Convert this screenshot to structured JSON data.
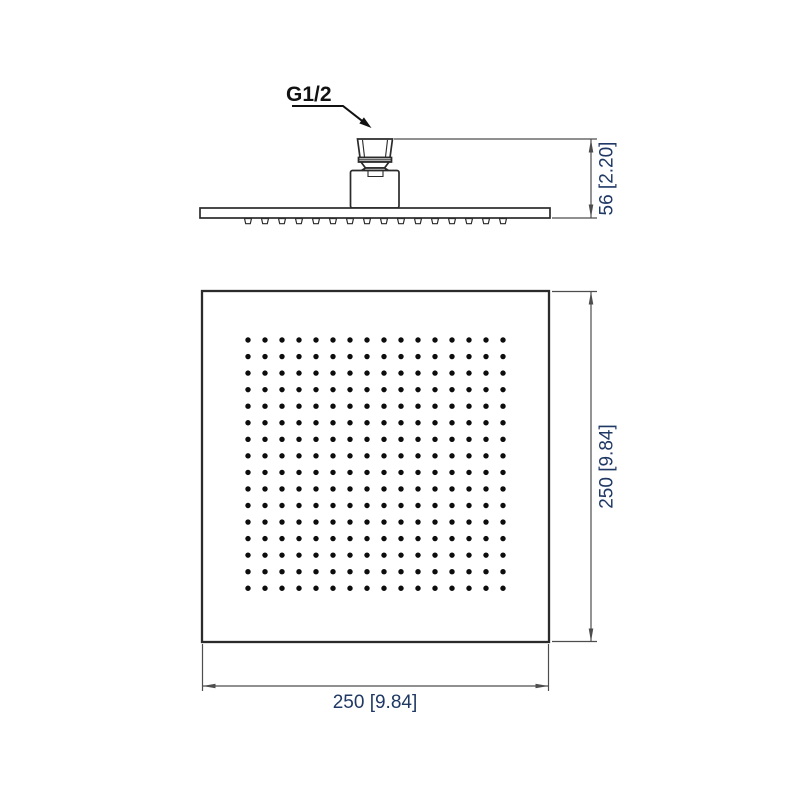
{
  "drawing": {
    "kind": "technical-dimension-drawing",
    "subject": "square-rain-shower-head",
    "labels": {
      "connection_thread": "G1/2",
      "side_height": "56 [2.20]",
      "front_height": "250 [9.84]",
      "front_width": "250 [9.84]"
    },
    "colors": {
      "background": "#ffffff",
      "outline": "#2b2b2b",
      "dimension_line": "#4d4d4d",
      "dimension_text": "#1f3864",
      "label_text": "#111111",
      "nozzle_dot": "#0d0d0d"
    },
    "front_nozzle_grid": {
      "rows": 16,
      "cols": 16,
      "x0": 248,
      "y0": 340,
      "dx": 17,
      "dy": 16.55,
      "dot_radius": 2.7
    },
    "side_nozzle_row": {
      "count": 16,
      "x0": 248,
      "dx": 17,
      "y_top": 218.5,
      "height": 5.2,
      "top_half_width": 3.5,
      "bottom_half_width": 2.3
    }
  }
}
